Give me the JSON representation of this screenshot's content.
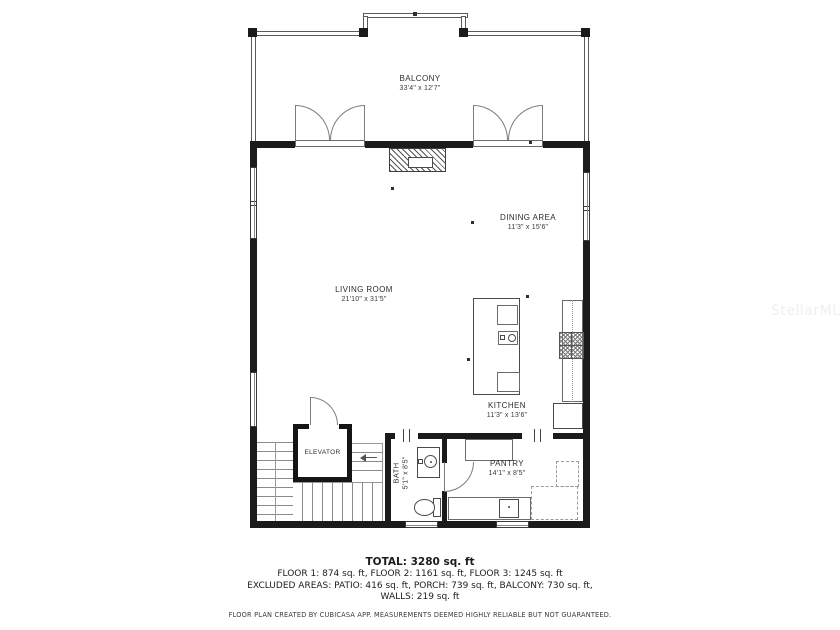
{
  "watermark": "StellarMLS",
  "colors": {
    "wall_ink": "#1b1b1b",
    "background": "#ffffff"
  },
  "rooms": {
    "balcony": {
      "name": "BALCONY",
      "dims": "33'4\" x 12'7\""
    },
    "dining": {
      "name": "DINING AREA",
      "dims": "11'3\" x 15'6\""
    },
    "living": {
      "name": "LIVING ROOM",
      "dims": "21'10\" x 31'5\""
    },
    "kitchen": {
      "name": "KITCHEN",
      "dims": "11'3\" x 13'6\""
    },
    "elevator": {
      "name": "ELEVATOR"
    },
    "bath": {
      "name": "BATH",
      "dims": "5'1\" x 8'5\""
    },
    "pantry": {
      "name": "PANTRY",
      "dims": "14'1\" x 8'5\""
    }
  },
  "summary": {
    "total": "TOTAL: 3280 sq. ft",
    "floors": "FLOOR 1: 874 sq. ft, FLOOR 2: 1161 sq. ft, FLOOR 3: 1245 sq. ft",
    "excluded": "EXCLUDED AREAS: PATIO: 416 sq. ft, PORCH: 739 sq. ft, BALCONY: 730 sq. ft,",
    "walls": "WALLS: 219 sq. ft",
    "disclaimer": "FLOOR PLAN CREATED BY CUBICASA APP. MEASUREMENTS DEEMED HIGHLY RELIABLE BUT NOT GUARANTEED."
  }
}
